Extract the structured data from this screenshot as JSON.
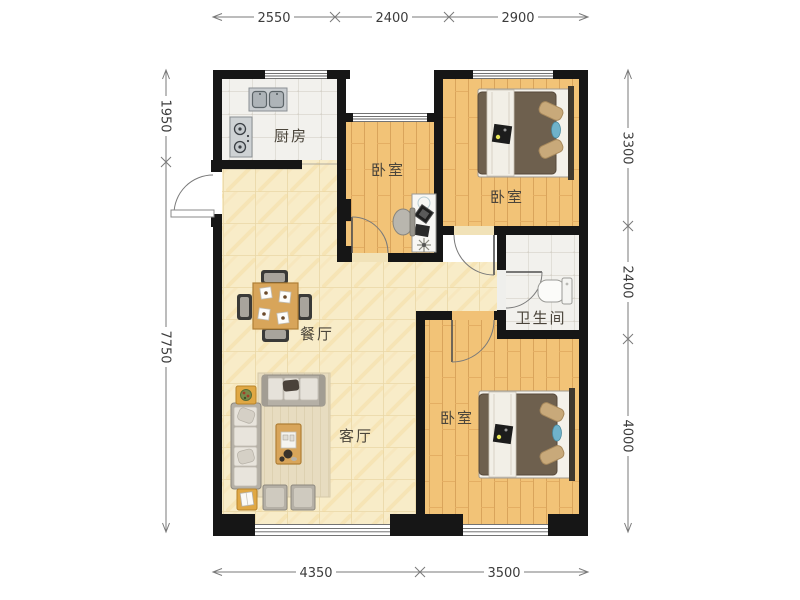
{
  "plan": {
    "rooms": {
      "kitchen": {
        "label": "厨房"
      },
      "bedroom_mid": {
        "label": "卧室"
      },
      "bedroom_right": {
        "label": "卧室"
      },
      "bathroom": {
        "label": "卫生间"
      },
      "dining": {
        "label": "餐厅"
      },
      "living": {
        "label": "客厅"
      },
      "bedroom_bottom": {
        "label": "卧室"
      }
    },
    "dimensions": {
      "top": [
        "2550",
        "2400",
        "2900"
      ],
      "bottom": [
        "4350",
        "3500"
      ],
      "left": [
        "1950",
        "7750"
      ],
      "right": [
        "3300",
        "2400",
        "4000"
      ]
    },
    "colors": {
      "wall": "#161616",
      "wood_floor": "#f2c377",
      "wood_plank_line": "#d9a45b",
      "tile_floor": "#f2f1ed",
      "marble_floor": "#f8ecc8",
      "rug": "#e7dcc0",
      "sofa": "#b5b0a6",
      "table_wood": "#d8a55a",
      "bed_blanket": "#6e604e",
      "pillow": "#c8a97a",
      "accent_blue": "#6fb2ca",
      "side_table": "#e0a844",
      "dim_line": "#7a7a7a",
      "dim_text": "#3c3c3c",
      "label_text": "#4b453b"
    }
  }
}
